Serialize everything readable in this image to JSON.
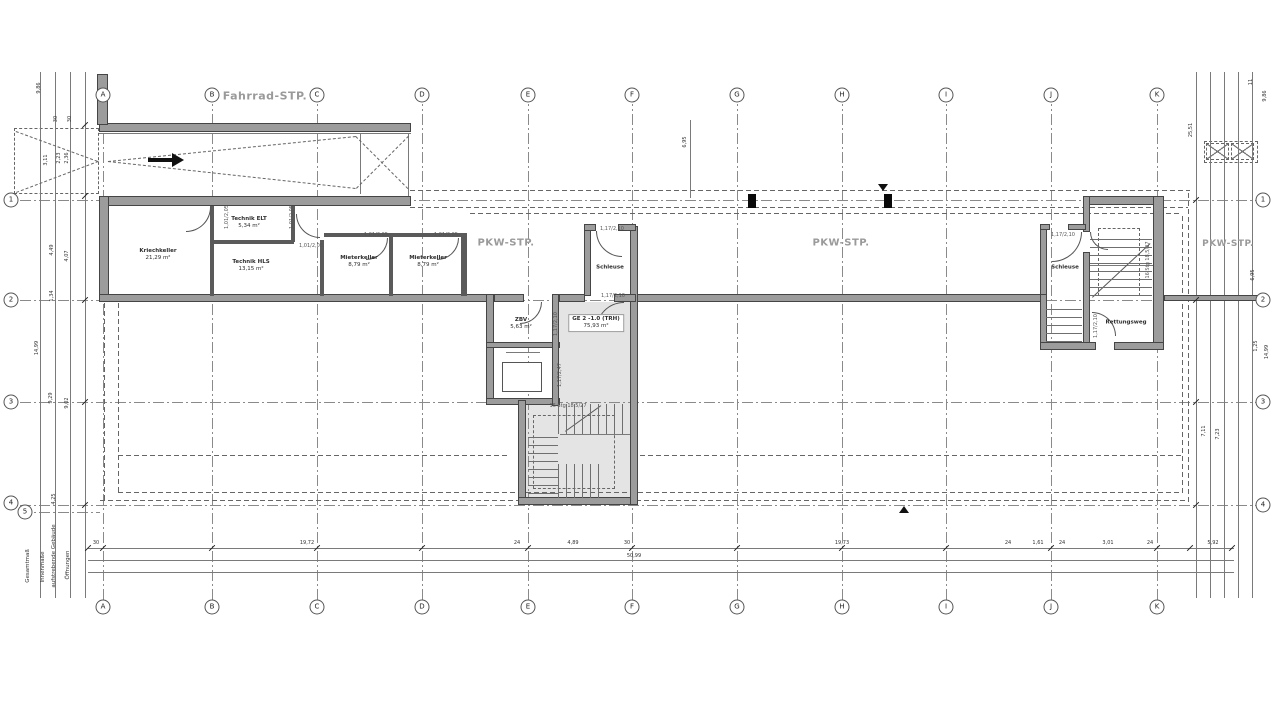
{
  "area_labels": {
    "fahrrad": "Fahrrad-STP.",
    "pkw": "PKW-STP."
  },
  "grid": {
    "letters": [
      {
        "l": "A",
        "x": 103
      },
      {
        "l": "B",
        "x": 212
      },
      {
        "l": "C",
        "x": 317
      },
      {
        "l": "D",
        "x": 422
      },
      {
        "l": "E",
        "x": 528
      },
      {
        "l": "F",
        "x": 632
      },
      {
        "l": "G",
        "x": 737
      },
      {
        "l": "H",
        "x": 842
      },
      {
        "l": "I",
        "x": 946
      },
      {
        "l": "J",
        "x": 1051
      },
      {
        "l": "K",
        "x": 1157
      }
    ],
    "top_y": 95,
    "bottom_y": 607,
    "rows": [
      {
        "n": "1",
        "y": 200
      },
      {
        "n": "2",
        "y": 300
      },
      {
        "n": "3",
        "y": 402
      },
      {
        "n": "4",
        "y": 505
      }
    ],
    "left_x": 11,
    "right_x": 1263,
    "extra_row": {
      "n": "5",
      "x": 25,
      "y": 512
    }
  },
  "rooms": [
    {
      "n": "Kriechkeller",
      "a": "21,29 m²",
      "x": 158,
      "y": 255
    },
    {
      "n": "Technik ELT",
      "a": "5,34 m²",
      "x": 249,
      "y": 223
    },
    {
      "n": "Technik HLS",
      "a": "13,15 m²",
      "x": 251,
      "y": 266
    },
    {
      "n": "Mieterkeller",
      "a": "8,79 m²",
      "x": 359,
      "y": 262
    },
    {
      "n": "Mieterkeller",
      "a": "8,79 m²",
      "x": 428,
      "y": 262
    },
    {
      "n": "ZBV",
      "a": "5,63 m²",
      "x": 521,
      "y": 324
    },
    {
      "n": "Schleuse",
      "a": "",
      "x": 610,
      "y": 268
    },
    {
      "n": "Schleuse",
      "a": "",
      "x": 1065,
      "y": 268
    },
    {
      "n": "Rettungsweg",
      "a": "",
      "x": 1126,
      "y": 323
    },
    {
      "n": "GE 2 -1.0 (TRH)",
      "a": "75,93 m²",
      "x": 596,
      "y": 323,
      "bg": 1
    }
  ],
  "texts": [
    {
      "t": "PKW-STP.",
      "x": 506,
      "y": 243,
      "s": 10,
      "c": "#9a9a9a",
      "b": 1,
      "ls": 0.5
    },
    {
      "t": "PKW-STP.",
      "x": 841,
      "y": 243,
      "s": 10,
      "c": "#9a9a9a",
      "b": 1,
      "ls": 0.5
    },
    {
      "t": "PKW-STP.",
      "x": 1228,
      "y": 244,
      "s": 9,
      "c": "#9a9a9a",
      "b": 1,
      "ls": 0.5
    },
    {
      "t": "30",
      "x": 96,
      "y": 544,
      "s": 5
    },
    {
      "t": "19,72",
      "x": 307,
      "y": 544,
      "s": 5
    },
    {
      "t": "24",
      "x": 517,
      "y": 544,
      "s": 5
    },
    {
      "t": "4,89",
      "x": 573,
      "y": 544,
      "s": 5
    },
    {
      "t": "30",
      "x": 627,
      "y": 544,
      "s": 5
    },
    {
      "t": "19,73",
      "x": 842,
      "y": 544,
      "s": 5
    },
    {
      "t": "24",
      "x": 1008,
      "y": 544,
      "s": 5
    },
    {
      "t": "1,61",
      "x": 1038,
      "y": 544,
      "s": 5
    },
    {
      "t": "24",
      "x": 1062,
      "y": 544,
      "s": 5
    },
    {
      "t": "3,01",
      "x": 1108,
      "y": 544,
      "s": 5
    },
    {
      "t": "24",
      "x": 1150,
      "y": 544,
      "s": 5
    },
    {
      "t": "5,92",
      "x": 1213,
      "y": 544,
      "s": 5
    },
    {
      "t": "50,99",
      "x": 634,
      "y": 557,
      "s": 5
    },
    {
      "t": "9,86",
      "x": 40,
      "y": 88,
      "s": 5,
      "r": 1
    },
    {
      "t": "30",
      "x": 57,
      "y": 119,
      "s": 5,
      "r": 1
    },
    {
      "t": "30",
      "x": 71,
      "y": 119,
      "s": 5,
      "r": 1
    },
    {
      "t": "3,11",
      "x": 47,
      "y": 160,
      "s": 5,
      "r": 1
    },
    {
      "t": "2,23",
      "x": 60,
      "y": 158,
      "s": 5,
      "r": 1
    },
    {
      "t": "2,36",
      "x": 68,
      "y": 158,
      "s": 5,
      "r": 1
    },
    {
      "t": "4,49",
      "x": 53,
      "y": 250,
      "s": 5,
      "r": 1
    },
    {
      "t": "4,07",
      "x": 68,
      "y": 256,
      "s": 5,
      "r": 1
    },
    {
      "t": "1,34",
      "x": 53,
      "y": 296,
      "s": 5,
      "r": 1
    },
    {
      "t": "14,99",
      "x": 38,
      "y": 348,
      "s": 5,
      "r": 1
    },
    {
      "t": "9,29",
      "x": 52,
      "y": 398,
      "s": 5,
      "r": 1
    },
    {
      "t": "9,02",
      "x": 68,
      "y": 403,
      "s": 5,
      "r": 1
    },
    {
      "t": "4,25",
      "x": 55,
      "y": 499,
      "s": 5,
      "r": 1
    },
    {
      "t": "25,51",
      "x": 1192,
      "y": 130,
      "s": 5,
      "r": 1
    },
    {
      "t": "11",
      "x": 1252,
      "y": 82,
      "s": 5,
      "r": 1
    },
    {
      "t": "9,86",
      "x": 1266,
      "y": 96,
      "s": 5,
      "r": 1
    },
    {
      "t": "6,95",
      "x": 1254,
      "y": 275,
      "s": 5,
      "r": 1
    },
    {
      "t": "1,25",
      "x": 1257,
      "y": 346,
      "s": 5,
      "r": 1
    },
    {
      "t": "14,99",
      "x": 1268,
      "y": 352,
      "s": 5,
      "r": 1
    },
    {
      "t": "7,11",
      "x": 1205,
      "y": 431,
      "s": 5,
      "r": 1
    },
    {
      "t": "7,23",
      "x": 1219,
      "y": 434,
      "s": 5,
      "r": 1
    },
    {
      "t": "6,95",
      "x": 686,
      "y": 142,
      "s": 5,
      "r": 1
    },
    {
      "t": "1,01/2,05",
      "x": 228,
      "y": 217,
      "s": 5,
      "c": "#555",
      "r": 1
    },
    {
      "t": "1,01/2,05",
      "x": 293,
      "y": 217,
      "s": 5,
      "c": "#555",
      "r": 1
    },
    {
      "t": "1,01/2,05",
      "x": 311,
      "y": 247,
      "s": 5,
      "c": "#555"
    },
    {
      "t": "1,01/2,05",
      "x": 376,
      "y": 236,
      "s": 5,
      "c": "#555"
    },
    {
      "t": "1,01/2,05",
      "x": 446,
      "y": 236,
      "s": 5,
      "c": "#555"
    },
    {
      "t": "1,17/2,10",
      "x": 612,
      "y": 230,
      "s": 5,
      "c": "#555"
    },
    {
      "t": "1,17/2,10",
      "x": 613,
      "y": 297,
      "s": 5,
      "c": "#555"
    },
    {
      "t": "1,17/2,10",
      "x": 557,
      "y": 324,
      "s": 5,
      "c": "#555",
      "r": 1
    },
    {
      "t": "1,17/2,47",
      "x": 561,
      "y": 375,
      "s": 5,
      "c": "#555",
      "r": 1
    },
    {
      "t": "1,17/2,10",
      "x": 1063,
      "y": 236,
      "s": 5,
      "c": "#555"
    },
    {
      "t": "1,17/2,10",
      "x": 1097,
      "y": 326,
      "s": 5,
      "c": "#555",
      "r": 1
    },
    {
      "t": "16 Stg 18,5/27",
      "x": 568,
      "y": 407,
      "s": 5,
      "c": "#555"
    },
    {
      "t": "16 Stg 18,5/27",
      "x": 1149,
      "y": 260,
      "s": 5,
      "c": "#555",
      "r": 1
    },
    {
      "t": "Gesamtmaß",
      "x": 28,
      "y": 566,
      "s": 5.5,
      "c": "#333",
      "r": 1
    },
    {
      "t": "Innenmaße",
      "x": 43,
      "y": 567,
      "s": 5.5,
      "c": "#333",
      "r": 1
    },
    {
      "t": "aufstrebende Gebäude",
      "x": 54,
      "y": 556,
      "s": 5.5,
      "c": "#333",
      "r": 1
    },
    {
      "t": "Öffnungen",
      "x": 68,
      "y": 565,
      "s": 5.5,
      "c": "#333",
      "r": 1
    }
  ],
  "geometry": {
    "walls": [
      [
        99,
        123,
        312,
        9
      ],
      [
        99,
        196,
        312,
        10
      ],
      [
        97,
        74,
        11,
        51
      ],
      [
        99,
        196,
        10,
        106
      ],
      [
        99,
        294,
        390,
        8
      ],
      [
        636,
        294,
        406,
        8
      ],
      [
        1164,
        295,
        94,
        6
      ],
      [
        486,
        294,
        8,
        110
      ],
      [
        486,
        342,
        74,
        6
      ],
      [
        486,
        398,
        74,
        7
      ],
      [
        552,
        294,
        7,
        112
      ],
      [
        518,
        400,
        8,
        104
      ],
      [
        518,
        497,
        120,
        8
      ],
      [
        630,
        226,
        8,
        279
      ],
      [
        584,
        226,
        7,
        70
      ],
      [
        584,
        224,
        12,
        7
      ],
      [
        618,
        224,
        18,
        7
      ],
      [
        494,
        294,
        30,
        8
      ],
      [
        559,
        294,
        26,
        8
      ],
      [
        614,
        294,
        22,
        8
      ],
      [
        1083,
        196,
        78,
        9
      ],
      [
        1153,
        196,
        11,
        153
      ],
      [
        1083,
        196,
        7,
        36
      ],
      [
        1083,
        252,
        7,
        96
      ],
      [
        1040,
        224,
        7,
        80
      ],
      [
        1040,
        224,
        10,
        6
      ],
      [
        1068,
        224,
        18,
        6
      ],
      [
        1040,
        294,
        7,
        56
      ],
      [
        1040,
        342,
        56,
        8
      ],
      [
        1114,
        342,
        50,
        8
      ]
    ],
    "thin": [
      [
        210,
        206,
        4,
        90
      ],
      [
        291,
        206,
        4,
        36
      ],
      [
        214,
        240,
        80,
        4
      ],
      [
        320,
        240,
        4,
        56
      ],
      [
        324,
        233,
        142,
        4
      ],
      [
        389,
        236,
        4,
        60
      ],
      [
        461,
        233,
        6,
        63
      ]
    ],
    "gray": [
      [
        559,
        302,
        71,
        196
      ],
      [
        526,
        402,
        33,
        96
      ]
    ],
    "dashH": [
      [
        410,
        190,
        780
      ],
      [
        410,
        207,
        778
      ],
      [
        100,
        500,
        1088
      ],
      [
        470,
        213,
        712
      ],
      [
        118,
        492,
        1064
      ],
      [
        118,
        455,
        392
      ],
      [
        640,
        455,
        542
      ]
    ],
    "dashV": [
      [
        1188,
        190,
        312
      ],
      [
        104,
        302,
        198
      ],
      [
        118,
        302,
        190
      ],
      [
        1182,
        213,
        280
      ]
    ],
    "dashRects": [
      [
        14,
        128,
        85,
        66
      ],
      [
        533,
        415,
        82,
        74
      ],
      [
        1098,
        228,
        42,
        68
      ],
      [
        1204,
        141,
        54,
        22
      ]
    ],
    "solidH": [
      [
        99,
        133,
        312
      ],
      [
        88,
        548,
        1146
      ],
      [
        88,
        560,
        1146
      ],
      [
        88,
        572,
        1146
      ],
      [
        506,
        352,
        34
      ],
      [
        560,
        434,
        70
      ],
      [
        1090,
        265,
        63
      ]
    ],
    "solidV": [
      [
        40,
        72,
        526
      ],
      [
        55,
        72,
        526
      ],
      [
        70,
        72,
        526
      ],
      [
        85,
        72,
        526
      ],
      [
        1196,
        72,
        526
      ],
      [
        1210,
        72,
        526
      ],
      [
        1224,
        72,
        526
      ],
      [
        1238,
        72,
        526
      ],
      [
        1252,
        72,
        526
      ],
      [
        360,
        134,
        60
      ],
      [
        408,
        134,
        62
      ],
      [
        690,
        120,
        78
      ]
    ],
    "inner": [
      [
        502,
        362,
        40,
        30
      ]
    ],
    "xboxes": [
      [
        1206,
        143,
        23,
        17
      ],
      [
        1231,
        143,
        23,
        17
      ]
    ],
    "treads": [
      {
        "x": 558,
        "y": 404,
        "w": 72,
        "h": 30,
        "d": "h"
      },
      {
        "x": 558,
        "y": 464,
        "w": 48,
        "h": 34,
        "d": "h"
      },
      {
        "x": 528,
        "y": 436,
        "w": 30,
        "h": 58,
        "d": "v"
      },
      {
        "x": 1090,
        "y": 232,
        "w": 62,
        "h": 64,
        "d": "v"
      },
      {
        "x": 1046,
        "y": 302,
        "w": 36,
        "h": 40,
        "d": "v"
      }
    ],
    "arcs": [
      {
        "x": 186,
        "y": 207,
        "w": 25,
        "h": 25,
        "q": "br"
      },
      {
        "x": 296,
        "y": 214,
        "w": 24,
        "h": 24,
        "q": "bl"
      },
      {
        "x": 366,
        "y": 238,
        "w": 22,
        "h": 22,
        "q": "br"
      },
      {
        "x": 437,
        "y": 238,
        "w": 22,
        "h": 22,
        "q": "br"
      },
      {
        "x": 596,
        "y": 231,
        "w": 26,
        "h": 26,
        "q": "bl"
      },
      {
        "x": 596,
        "y": 302,
        "w": 28,
        "h": 28,
        "q": "tl"
      },
      {
        "x": 520,
        "y": 302,
        "w": 22,
        "h": 22,
        "q": "br"
      },
      {
        "x": 1052,
        "y": 232,
        "w": 30,
        "h": 30,
        "q": "br"
      },
      {
        "x": 1090,
        "y": 232,
        "w": 18,
        "h": 18,
        "q": "bl"
      },
      {
        "x": 1092,
        "y": 312,
        "w": 24,
        "h": 24,
        "q": "tr"
      }
    ],
    "cols": [
      [
        748,
        194,
        8,
        14
      ],
      [
        884,
        194,
        8,
        14
      ]
    ],
    "tris": [
      {
        "x": 878,
        "y": 184,
        "d": "d"
      },
      {
        "x": 899,
        "y": 506,
        "d": "u"
      }
    ],
    "diags": [
      {
        "x1": 108,
        "y1": 161,
        "x2": 356,
        "y2": 136,
        "ds": 1
      },
      {
        "x1": 108,
        "y1": 161,
        "x2": 356,
        "y2": 188,
        "ds": 1
      },
      {
        "x1": 356,
        "y1": 136,
        "x2": 408,
        "y2": 188,
        "ds": 1
      },
      {
        "x1": 356,
        "y1": 188,
        "x2": 408,
        "y2": 136,
        "ds": 1
      },
      {
        "x1": 16,
        "y1": 131,
        "x2": 98,
        "y2": 161,
        "ds": 1
      },
      {
        "x1": 16,
        "y1": 192,
        "x2": 98,
        "y2": 161,
        "ds": 1
      },
      {
        "x1": 565,
        "y1": 431,
        "x2": 601,
        "y2": 405,
        "ds": 0
      },
      {
        "x1": 1092,
        "y1": 297,
        "x2": 1150,
        "y2": 243,
        "ds": 0
      }
    ],
    "arrow": {
      "shaft": [
        148,
        158,
        24,
        4
      ],
      "head": [
        172,
        153
      ]
    },
    "ticks": {
      "bottom": {
        "y": 548,
        "xs": [
          88,
          103,
          212,
          317,
          422,
          528,
          632,
          737,
          842,
          946,
          1051,
          1157,
          1190,
          1232
        ]
      },
      "left": {
        "x": 85,
        "ys": [
          125,
          196,
          300,
          402,
          505
        ]
      },
      "right": {
        "x": 1196,
        "ys": [
          200,
          300,
          402,
          505
        ]
      }
    }
  }
}
